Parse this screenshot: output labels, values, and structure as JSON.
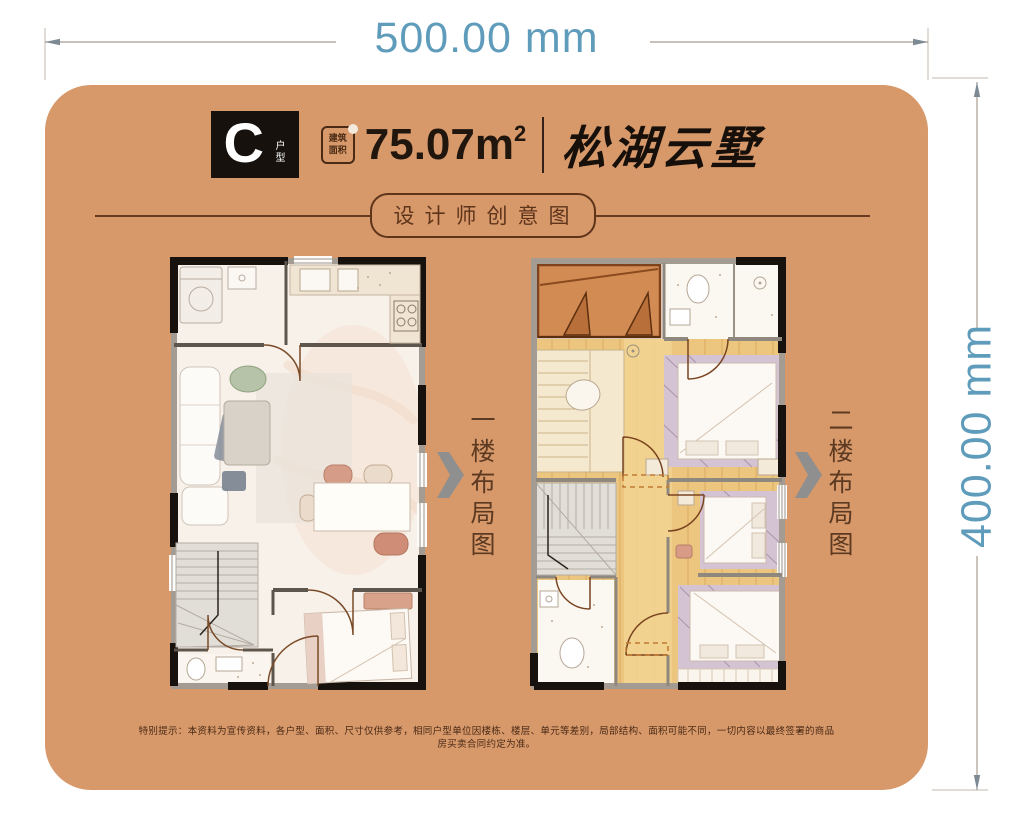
{
  "dimensions": {
    "width_label": "500.00 mm",
    "height_label": "400.00 mm"
  },
  "card": {
    "header": {
      "unit_letter": "C",
      "unit_suffix": "户型",
      "area_badge": {
        "line1": "建筑",
        "line2": "面积"
      },
      "area_value": "75.07m",
      "area_sup": "2",
      "project_name": "松湖云墅"
    },
    "subtitle": "设计师创意图",
    "floor_labels": {
      "floor1": "一楼布局图",
      "floor2": "二楼布局图"
    },
    "disclaimer": "特别提示：本资料为宣传资料，各户型、面积、尺寸仅供参考，相同户型单位因楼栋、楼层、单元等差别，局部结构、面积可能不同，一切内容以最终签署的商品房买卖合同约定为准。"
  },
  "colors": {
    "card_background": "#d7986a",
    "dimension_text": "#5f9cbb",
    "accent_dark_brown": "#5e341b",
    "terrace_orange": "#d28b53",
    "wood_floor": "#ecc67f"
  }
}
